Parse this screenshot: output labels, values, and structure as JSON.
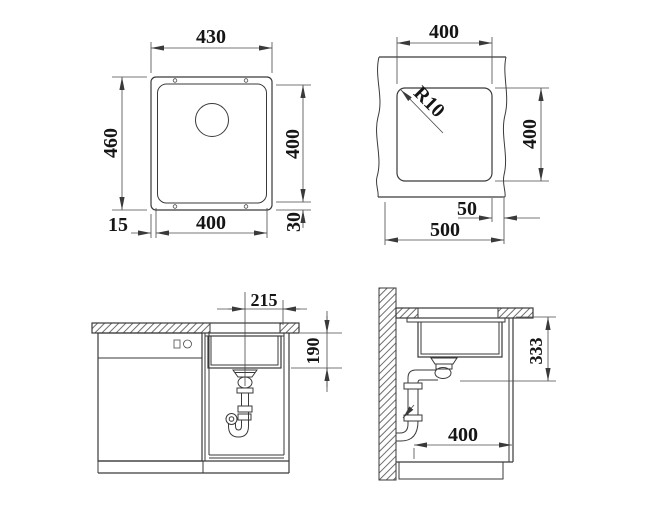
{
  "drawing": {
    "type": "sink installation technical drawing",
    "views": {
      "sink_plan": {
        "overall_width": "430",
        "overall_depth": "460",
        "bowl_depth": "400",
        "flange_side": "15",
        "bowl_width": "400",
        "flange_back": "30"
      },
      "cutout_plan": {
        "cutout_width": "400",
        "corner_radius": "R10",
        "cutout_depth": "400",
        "edge_distance": "50",
        "min_cabinet_width": "500"
      },
      "front_section": {
        "center_to_edge": "215",
        "bowl_height": "190"
      },
      "side_section": {
        "install_height": "333",
        "clear_depth": "400"
      }
    },
    "line_color": "#3a3a3a",
    "text_color": "#151515",
    "background": "#ffffff"
  }
}
